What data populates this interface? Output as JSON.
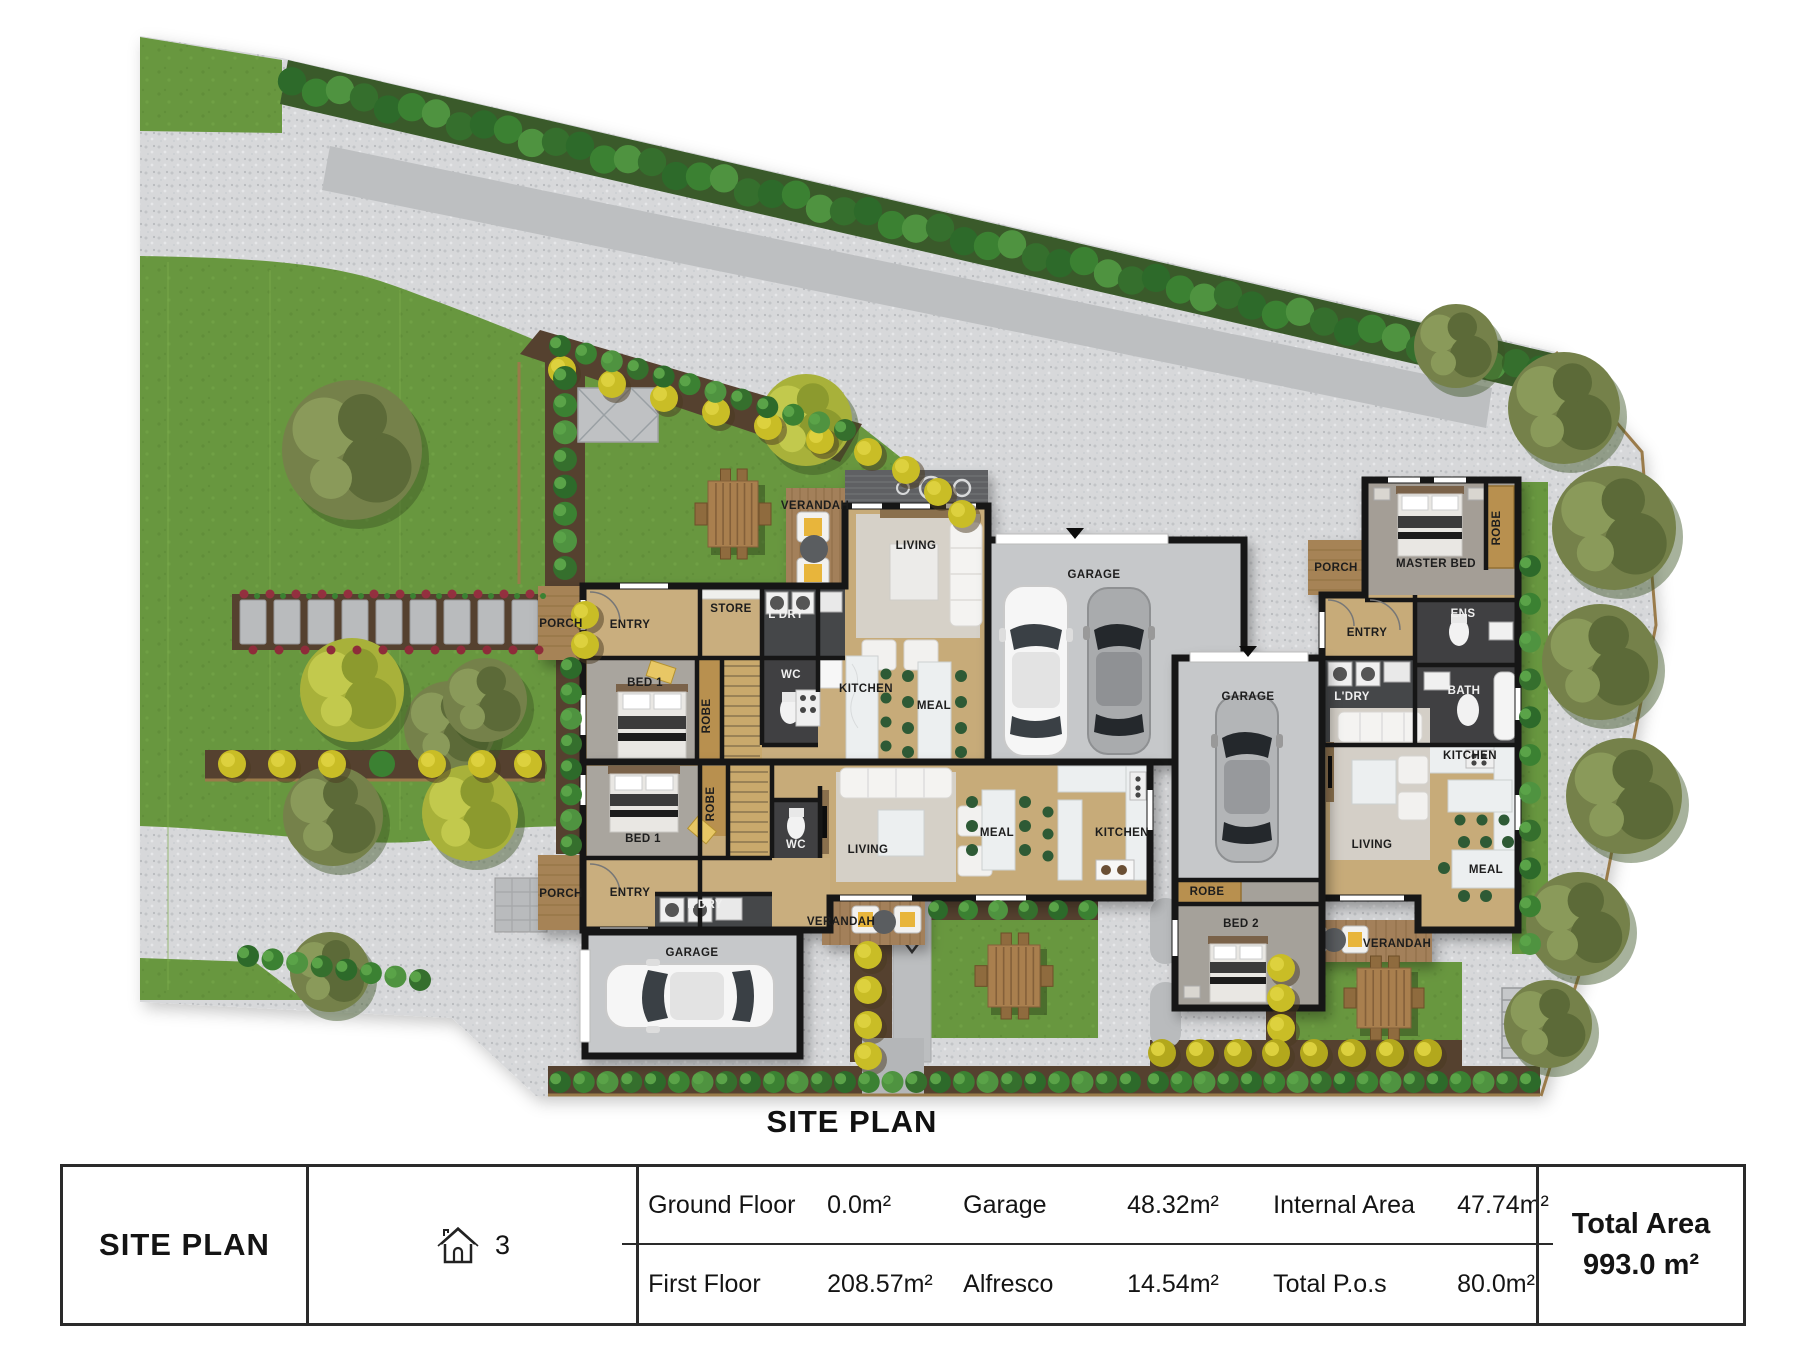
{
  "plan_title": "SITE PLAN",
  "legend": {
    "name": "SITE PLAN",
    "lot_number": "3",
    "rows": [
      {
        "l1": "Ground Floor",
        "v1": "0.0m²",
        "l2": "Garage",
        "v2": "48.32m²",
        "l3": "Internal Area",
        "v3": "47.74m²"
      },
      {
        "l1": "First Floor",
        "v1": "208.57m²",
        "l2": "Alfresco",
        "v2": "14.54m²",
        "l3": "Total P.o.s",
        "v3": "80.0m²"
      }
    ],
    "total_label": "Total Area",
    "total_value": "993.0 m²"
  },
  "site_plan": {
    "room_labels": [
      {
        "text": "VERANDAH",
        "x": 815,
        "y": 509
      },
      {
        "text": "LIVING",
        "x": 916,
        "y": 549
      },
      {
        "text": "STORE",
        "x": 731,
        "y": 612
      },
      {
        "text": "L'DRY",
        "x": 786,
        "y": 618,
        "tone": "w"
      },
      {
        "text": "ENTRY",
        "x": 630,
        "y": 628
      },
      {
        "text": "PORCH",
        "x": 561,
        "y": 627
      },
      {
        "text": "BED 1",
        "x": 645,
        "y": 686
      },
      {
        "text": "ROBE",
        "x": 710,
        "y": 716,
        "rot": -90
      },
      {
        "text": "WC",
        "x": 791,
        "y": 678,
        "tone": "w"
      },
      {
        "text": "KITCHEN",
        "x": 866,
        "y": 692
      },
      {
        "text": "MEAL",
        "x": 934,
        "y": 709
      },
      {
        "text": "GARAGE",
        "x": 1094,
        "y": 578
      },
      {
        "text": "BED 1",
        "x": 643,
        "y": 842
      },
      {
        "text": "ROBE",
        "x": 714,
        "y": 804,
        "rot": -90
      },
      {
        "text": "WC",
        "x": 796,
        "y": 848,
        "tone": "w"
      },
      {
        "text": "LIVING",
        "x": 868,
        "y": 853
      },
      {
        "text": "ENTRY",
        "x": 630,
        "y": 896
      },
      {
        "text": "L'DRY",
        "x": 705,
        "y": 908,
        "tone": "w"
      },
      {
        "text": "PORCH",
        "x": 561,
        "y": 897
      },
      {
        "text": "GARAGE",
        "x": 692,
        "y": 956
      },
      {
        "text": "VERANDAH",
        "x": 841,
        "y": 925
      },
      {
        "text": "MEAL",
        "x": 997,
        "y": 836
      },
      {
        "text": "KITCHEN",
        "x": 1122,
        "y": 836
      },
      {
        "text": "GARAGE",
        "x": 1248,
        "y": 700
      },
      {
        "text": "ROBE",
        "x": 1207,
        "y": 895
      },
      {
        "text": "BED 2",
        "x": 1241,
        "y": 927
      },
      {
        "text": "PORCH",
        "x": 1336,
        "y": 571
      },
      {
        "text": "ENTRY",
        "x": 1367,
        "y": 636
      },
      {
        "text": "MASTER BED",
        "x": 1436,
        "y": 567
      },
      {
        "text": "ROBE",
        "x": 1500,
        "y": 528,
        "rot": -90
      },
      {
        "text": "ENS",
        "x": 1463,
        "y": 617,
        "tone": "w"
      },
      {
        "text": "BATH",
        "x": 1464,
        "y": 694,
        "tone": "w"
      },
      {
        "text": "L'DRY",
        "x": 1352,
        "y": 700,
        "tone": "w"
      },
      {
        "text": "KITCHEN",
        "x": 1470,
        "y": 759
      },
      {
        "text": "LIVING",
        "x": 1372,
        "y": 848
      },
      {
        "text": "MEAL",
        "x": 1486,
        "y": 873
      },
      {
        "text": "VERANDAH",
        "x": 1397,
        "y": 947
      }
    ],
    "colors": {
      "lawn": "#68973f",
      "road": "#d6d7d9",
      "wall": "#141414",
      "floor": "#c7ac7a",
      "deck": "#a3805a"
    }
  }
}
